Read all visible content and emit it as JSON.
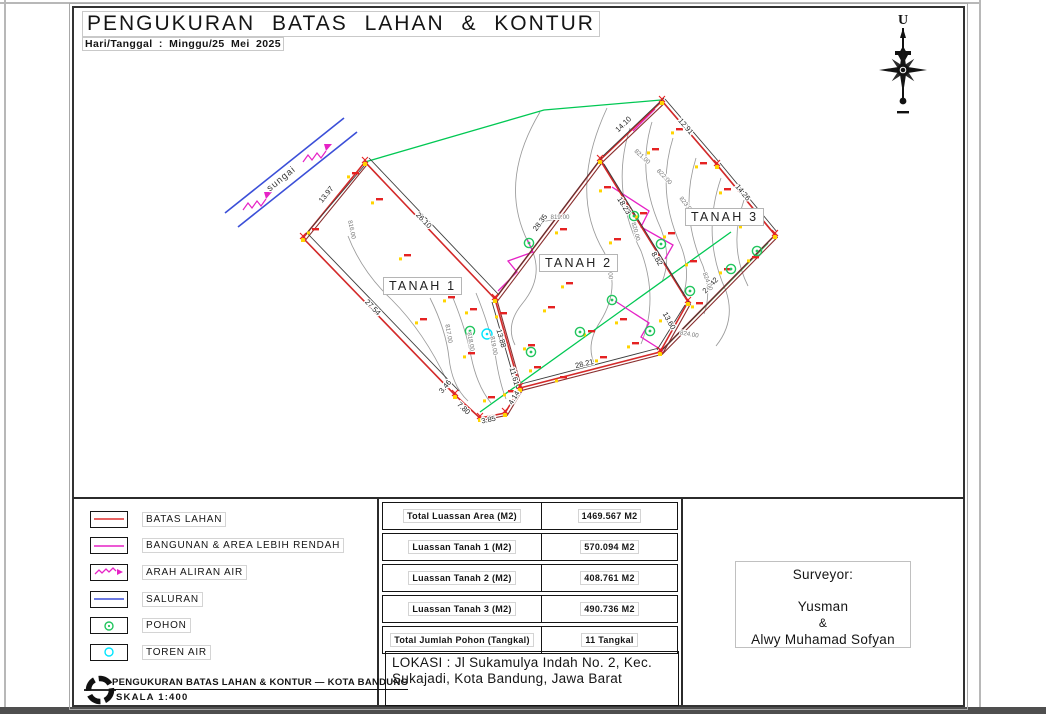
{
  "frame": {
    "title": "PENGUKURAN BATAS LAHAN & KONTUR",
    "date_line": "Hari/Tanggal : Minggu/25 Mei 2025"
  },
  "compass": {
    "north_label": "U"
  },
  "map": {
    "parcels": [
      {
        "label": "TANAH 1"
      },
      {
        "label": "TANAH 2"
      },
      {
        "label": "TANAH 3"
      }
    ],
    "river_label": "sungai",
    "dimensions": [
      {
        "value": "13.97"
      },
      {
        "value": "26.10"
      },
      {
        "value": "27.54"
      },
      {
        "value": "13.88"
      },
      {
        "value": "4.14"
      },
      {
        "value": "3.85"
      },
      {
        "value": "7.80"
      },
      {
        "value": "11.61"
      },
      {
        "value": "3.46"
      },
      {
        "value": "28.35"
      },
      {
        "value": "14.10"
      },
      {
        "value": "18.23"
      },
      {
        "value": "8.82"
      },
      {
        "value": "12.91"
      },
      {
        "value": "14.26"
      },
      {
        "value": "24.42"
      },
      {
        "value": "13.60"
      },
      {
        "value": "28.21"
      }
    ],
    "contour_labels": [
      {
        "value": "816.00"
      },
      {
        "value": "817.00"
      },
      {
        "value": "818.00"
      },
      {
        "value": "819.00"
      },
      {
        "value": "819.00"
      },
      {
        "value": "818.00"
      },
      {
        "value": "820.00"
      },
      {
        "value": "821.00"
      },
      {
        "value": "822.00"
      },
      {
        "value": "823.00"
      },
      {
        "value": "824.00"
      },
      {
        "value": "824.00"
      }
    ],
    "colors": {
      "boundary_red": "#d42a2a",
      "boundary_shadow": "#8a2f2f",
      "contour_gray": "#9a9a9a",
      "planning_green": "#00c853",
      "channel_blue": "#3b4fd8",
      "building_magenta": "#e622c6",
      "tree_green": "#22c55e",
      "water_tank_cyan": "#00e5ff",
      "spot_marker_red": "#e52222",
      "spot_marker_yellow": "#ffd400"
    }
  },
  "legend": {
    "items": [
      {
        "label": "BATAS LAHAN",
        "symbol": "red-line",
        "color": "#e03131"
      },
      {
        "label": "BANGUNAN & AREA LEBIH RENDAH",
        "symbol": "magenta-line",
        "color": "#e622c6"
      },
      {
        "label": "ARAH ALIRAN AIR",
        "symbol": "magenta-wavy-arrow",
        "color": "#e622c6"
      },
      {
        "label": "SALURAN",
        "symbol": "blue-line",
        "color": "#3b4fd8"
      },
      {
        "label": "POHON",
        "symbol": "green-circle",
        "color": "#22c55e"
      },
      {
        "label": "TOREN AIR",
        "symbol": "cyan-circle",
        "color": "#00e5ff"
      }
    ]
  },
  "summary_table": {
    "rows": [
      {
        "label": "Total Luassan Area (M2)",
        "value": "1469.567 M2"
      },
      {
        "label": "Luassan Tanah 1 (M2)",
        "value": "570.094 M2"
      },
      {
        "label": "Luassan Tanah 2 (M2)",
        "value": "408.761 M2"
      },
      {
        "label": "Luassan Tanah 3 (M2)",
        "value": "490.736 M2"
      },
      {
        "label": "Total Jumlah Pohon (Tangkal)",
        "value": "11 Tangkal"
      }
    ]
  },
  "surveyor": {
    "heading": "Surveyor:",
    "names": [
      "Yusman",
      "&",
      "Alwy Muhamad Sofyan"
    ]
  },
  "location": {
    "text": "LOKASI : Jl Sukamulya Indah No. 2, Kec. Sukajadi, Kota Bandung, Jawa Barat"
  },
  "footer": {
    "title": "PENGUKURAN BATAS LAHAN & KONTUR — KOTA BANDUNG",
    "scale": "SKALA 1:400"
  }
}
